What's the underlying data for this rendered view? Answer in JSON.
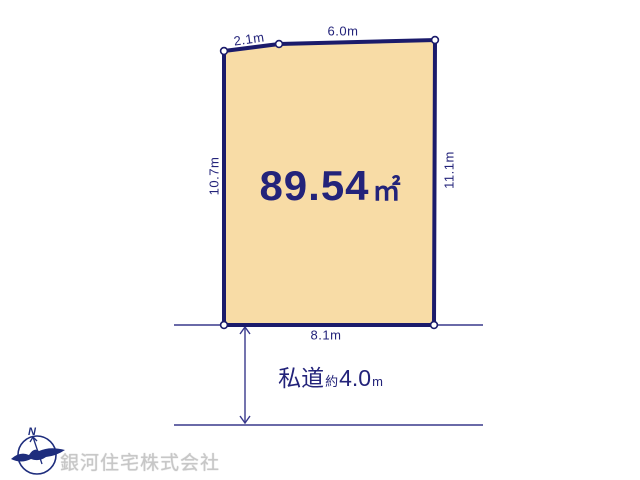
{
  "plot": {
    "area_value": "89.54",
    "area_unit": "㎡",
    "dim_top_left": "2.1m",
    "dim_top": "6.0m",
    "dim_left": "10.7m",
    "dim_right": "11.1m",
    "dim_bottom": "8.1m"
  },
  "road": {
    "label": "私道",
    "approx": "約",
    "value": "4.0",
    "unit": "m"
  },
  "compass": {
    "north": "N"
  },
  "footer": {
    "company": "銀河住宅株式会社"
  },
  "colors": {
    "outline_navy": "#1b1b6b",
    "text_navy": "#23237a",
    "plot_fill": "#f8dca6",
    "thin_line": "#39398c",
    "watermark_gray": "#c7c7c7"
  }
}
